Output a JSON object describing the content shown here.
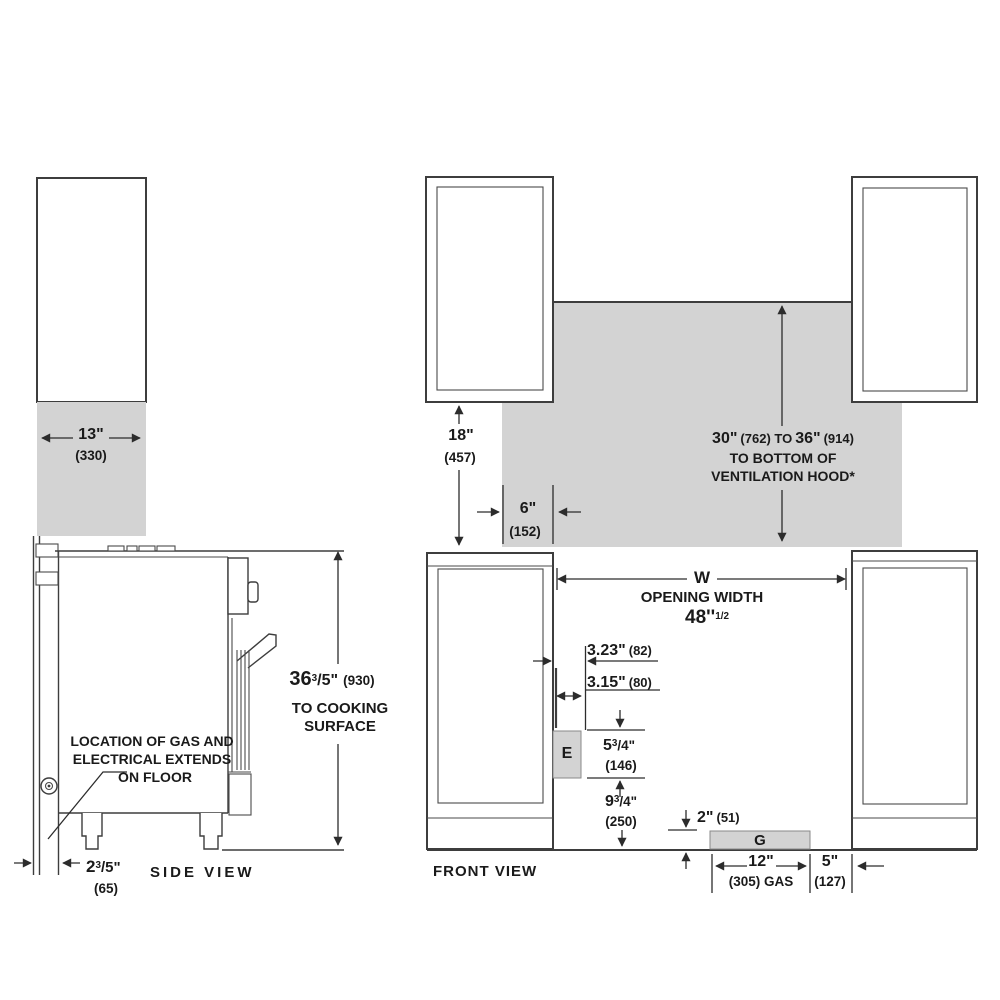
{
  "colors": {
    "gray_fill": "#d3d3d3",
    "line": "#3d3d3d",
    "text": "#1a1a1a"
  },
  "side_view": {
    "view_label": "SIDE VIEW",
    "upper_cabinet_depth": {
      "inches": "13\"",
      "mm": "(330)"
    },
    "cooking_surface_height": {
      "base": "36",
      "sup": "3",
      "frac": "/5\"",
      "mm": "(930)",
      "line2": "TO COOKING",
      "line3": "SURFACE"
    },
    "gas_electrical_note": {
      "line1": "LOCATION OF GAS AND",
      "line2": "ELECTRICAL EXTENDS",
      "line3": "ON FLOOR"
    },
    "rear_gap": {
      "base": "2",
      "sup": "3",
      "frac": "/5\"",
      "mm": "(65)"
    }
  },
  "front_view": {
    "view_label": "FRONT VIEW",
    "upper_cabinet_height": {
      "inches": "18\"",
      "mm": "(457)"
    },
    "side_overhang": {
      "inches": "6\"",
      "mm": "(152)"
    },
    "hood_clearance": {
      "min_in": "30\"",
      "min_mm": "(762) TO",
      "max_in": "36\"",
      "max_mm": "(914)",
      "line2": "TO BOTTOM OF",
      "line3": "VENTILATION HOOD*"
    },
    "opening_width": {
      "symbol": "W",
      "label": "OPENING WIDTH",
      "value": "48''",
      "value_sup": "1/2"
    },
    "electrical_offset_depth": {
      "inches": "3.23\"",
      "mm": "(82)"
    },
    "electrical_offset_side": {
      "inches": "3.15\"",
      "mm": "(80)"
    },
    "electrical_box_label": "E",
    "electrical_box_height": {
      "base": "5",
      "sup": "3",
      "frac": "/4\"",
      "mm": "(146)"
    },
    "electrical_box_to_floor": {
      "base": "9",
      "sup": "3",
      "frac": "/4\"",
      "mm": "(250)"
    },
    "gas_box_label": "G",
    "gas_height": {
      "inches": "2\"",
      "mm": "(51)"
    },
    "gas_width": {
      "inches": "12\"",
      "mm": "(305) GAS"
    },
    "gas_side_offset": {
      "inches": "5\"",
      "mm": "(127)"
    }
  }
}
